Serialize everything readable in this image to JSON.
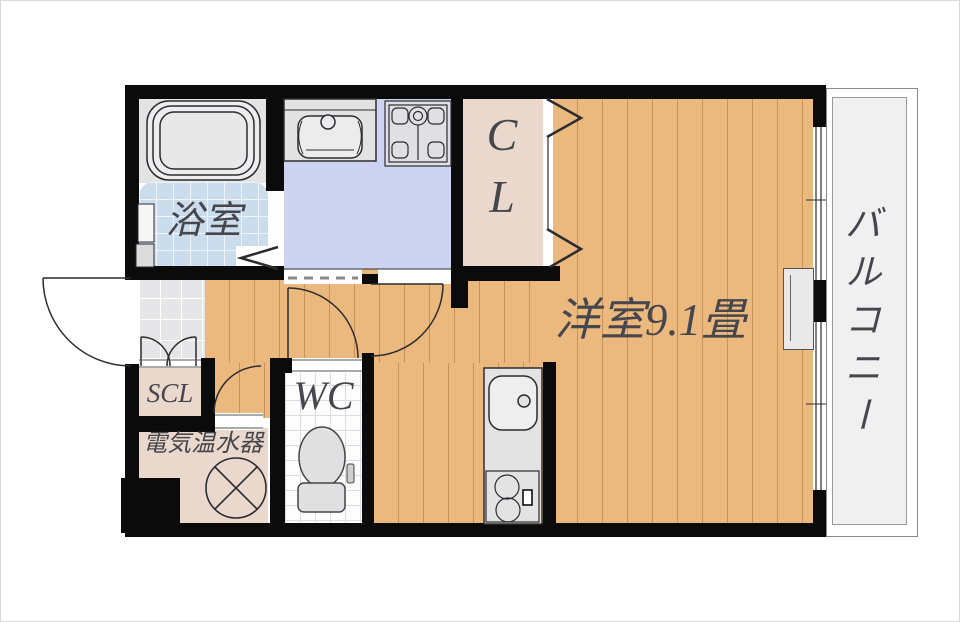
{
  "plan": {
    "title": "1K apartment floor plan",
    "rooms": {
      "bathroom": {
        "label": "浴室"
      },
      "main_room": {
        "label": "洋室9.1畳"
      },
      "closet": {
        "label": "CL",
        "line1": "C",
        "line2": "L"
      },
      "shoe_closet": {
        "label": "SCL"
      },
      "toilet_room": {
        "label": "WC"
      },
      "water_heater": {
        "label": "電気温水器"
      },
      "balcony": {
        "label": "バルコニー"
      }
    },
    "colors": {
      "wall": "#0b0b0b",
      "wood_floor": "#ebb87e",
      "washroom_floor": "#ccd4f1",
      "bathroom_floor": "#cbdded",
      "closet_floor": "#e9d8cb",
      "entrance_tile": "#e6e6e9",
      "balcony_floor": "#f0f0f1",
      "label_text": "#46464d"
    }
  }
}
